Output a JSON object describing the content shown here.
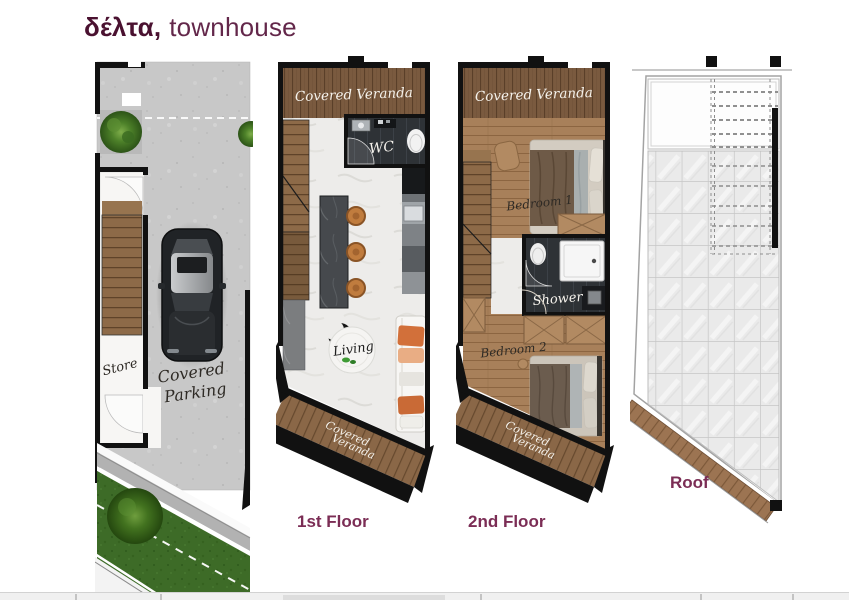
{
  "header": {
    "title_bold": "δέλτα,",
    "title_rest": "townhouse"
  },
  "colors": {
    "title": "#4a1130",
    "accent": "#7b2d55",
    "accent2": "#63274a"
  },
  "ground_floor": {
    "store": "Store",
    "parking_l1": "Covered",
    "parking_l2": "Parking"
  },
  "first_floor": {
    "caption": "1st Floor",
    "veranda_top": "Covered Veranda",
    "wc": "WC",
    "living": "Living",
    "veranda_bottom_l1": "Covered",
    "veranda_bottom_l2": "Veranda"
  },
  "second_floor": {
    "caption": "2nd Floor",
    "veranda_top": "Covered Veranda",
    "bedroom1": "Bedroom 1",
    "shower": "Shower",
    "bedroom2": "Bedroom 2",
    "veranda_bottom_l1": "Covered",
    "veranda_bottom_l2": "Veranda"
  },
  "roof": {
    "caption": "Roof"
  }
}
